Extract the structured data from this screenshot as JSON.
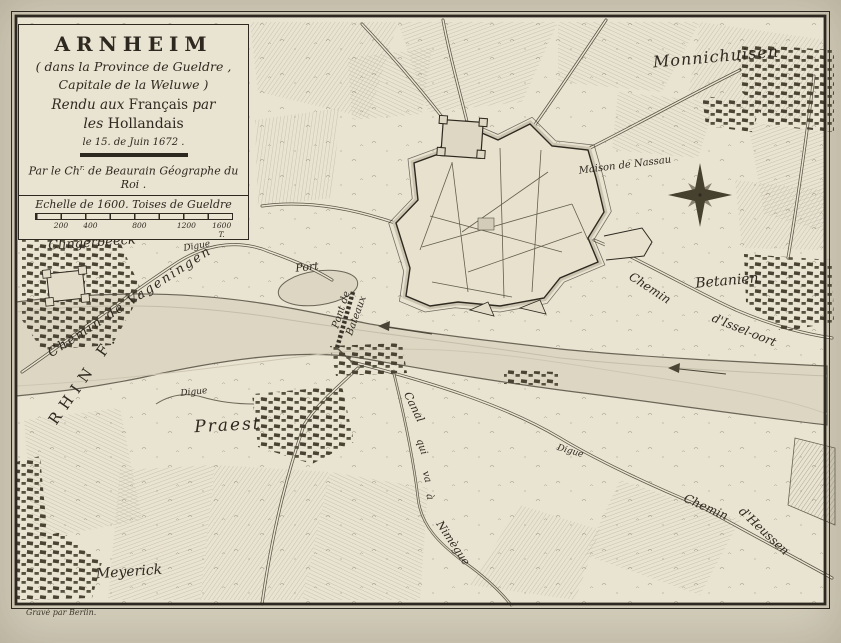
{
  "cartouche": {
    "title": "ARNHEIM",
    "line2": "( dans la Province de Gueldre ,",
    "line3": "Capitale de la Weluwe )",
    "line4_a": "Rendu aux",
    "line4_b": "Français",
    "line4_c": "par",
    "line5_a": "les",
    "line5_b": "Hollandais",
    "date": "le 15. de Juin 1672 .",
    "author_a": "Par le Ch",
    "author_sup": "r.",
    "author_b": " de Beaurain Géographe du Roi ."
  },
  "scale": {
    "label": "Echelle de 1600. Toises de Gueldre",
    "ticks": [
      "200",
      "400",
      "800",
      "1200",
      "1600 T."
    ]
  },
  "labels": {
    "monnichuisen": "Monnichuisen",
    "clingerbeeck": "Clingerbeeck",
    "betanien": "Betanien",
    "praest": "Praest",
    "meyerick": "Meyerick",
    "maison_nassau": "Maison de Nassau",
    "port": "Port",
    "rhin": "RHIN F.",
    "digue": "Digue",
    "chemin_vageningen": "Chemin de Vageningen",
    "chemin_issel_a": "Chemin",
    "chemin_issel_b": "d'Issel-oort",
    "chemin_heussen_a": "Chemin",
    "chemin_heussen_b": "d'Heussen",
    "canal_1": "Canal",
    "canal_2": "qui",
    "canal_3": "va",
    "canal_4": "à",
    "canal_5": "Nimègue",
    "pont_a": "Pont de",
    "pont_b": "Bateaux",
    "credit": "Gravé par Berlin."
  },
  "colors": {
    "paper": "#d3cdbb",
    "plate": "#e9e3d1",
    "ink": "#2e2920",
    "river": "#dcd6c3"
  }
}
